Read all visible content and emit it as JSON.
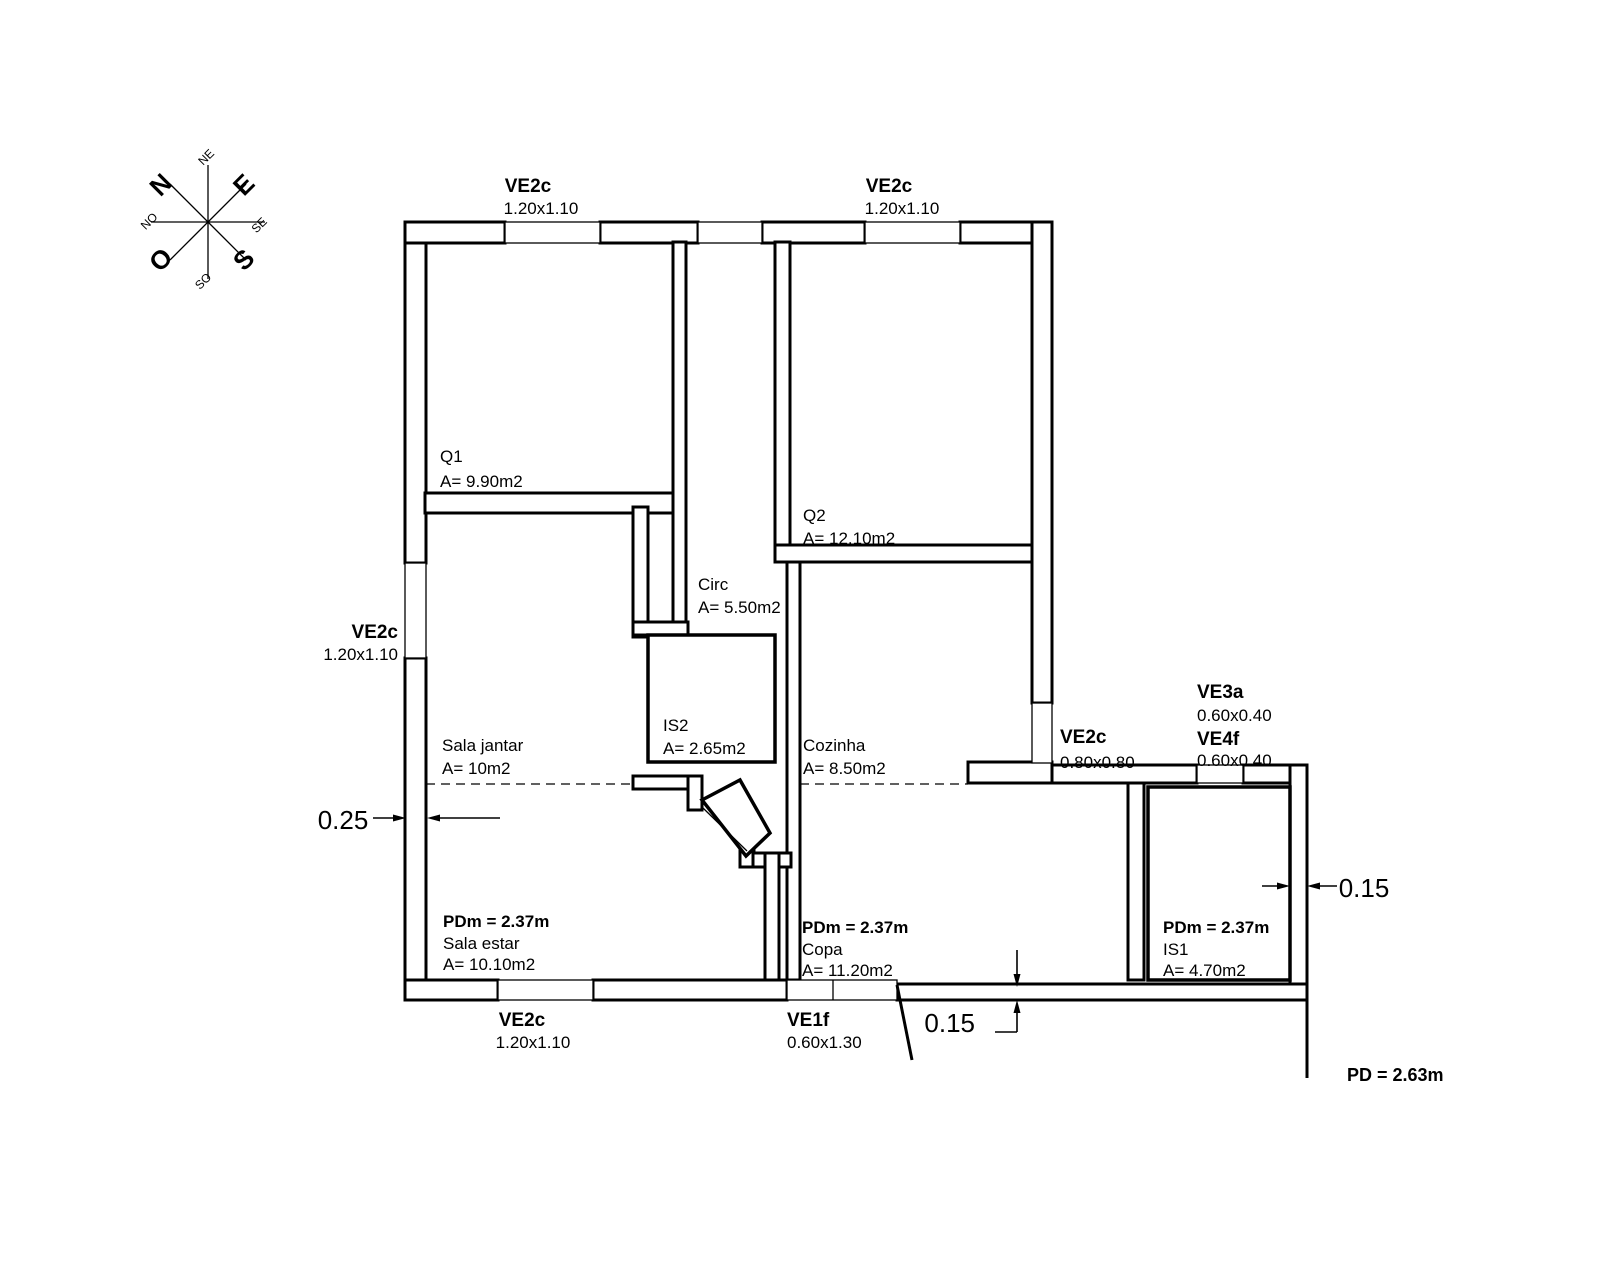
{
  "compass": {
    "cardinals": [
      "N",
      "E",
      "S",
      "O"
    ],
    "intercardinals": [
      "NE",
      "SE",
      "SO",
      "NO"
    ]
  },
  "windows": [
    {
      "label": "VE2c",
      "size": "1.20x1.10"
    },
    {
      "label": "VE2c",
      "size": "1.20x1.10"
    },
    {
      "label": "VE2c",
      "size": "1.20x1.10"
    },
    {
      "label": "VE2c",
      "size": "1.20x1.10"
    },
    {
      "label": "VE1f",
      "size": "0.60x1.30"
    },
    {
      "label": "VE2c",
      "size": "0.80x0.80"
    },
    {
      "label": "VE3a",
      "size": "0.60x0.40"
    },
    {
      "label": "VE4f",
      "size": "0.60x0.40"
    }
  ],
  "rooms": [
    {
      "name": "Q1",
      "area": "A= 9.90m2"
    },
    {
      "name": "Q2",
      "area": "A= 12.10m2"
    },
    {
      "name": "Circ",
      "area": "A= 5.50m2"
    },
    {
      "name": "IS2",
      "area": "A= 2.65m2"
    },
    {
      "name": "Sala jantar",
      "area": "A= 10m2"
    },
    {
      "name": "Cozinha",
      "area": "A= 8.50m2"
    },
    {
      "name": "Sala estar",
      "area": "A= 10.10m2",
      "ceiling": "PDm = 2.37m"
    },
    {
      "name": "Copa",
      "area": "A= 11.20m2",
      "ceiling": "PDm = 2.37m"
    },
    {
      "name": "IS1",
      "area": "A= 4.70m2",
      "ceiling": "PDm = 2.37m"
    }
  ],
  "dimensions": [
    {
      "value": "0.25"
    },
    {
      "value": "0.15"
    },
    {
      "value": "0.15"
    }
  ],
  "notes": {
    "ceiling_height": "PD = 2.63m"
  },
  "colors": {
    "dimension_red": "#c85050",
    "line": "#000000",
    "background": "#ffffff"
  }
}
